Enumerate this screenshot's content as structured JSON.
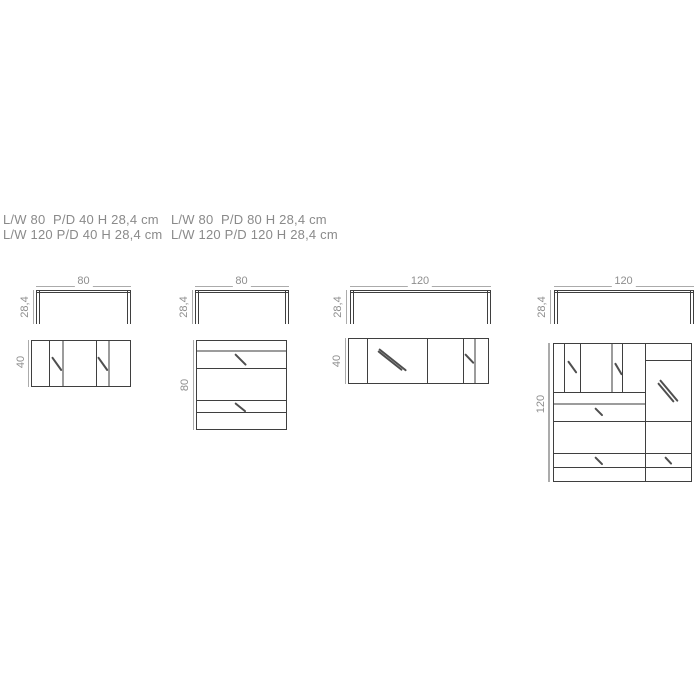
{
  "specs": {
    "col1": [
      "L/W 80  P/D 40 H 28,4 cm",
      "L/W 120 P/D 40 H 28,4 cm"
    ],
    "col2": [
      "L/W 80  P/D 80 H 28,4 cm",
      "L/W 120 P/D 120 H 28,4 cm"
    ]
  },
  "drawings": [
    {
      "width": "80",
      "height": "28,4",
      "depth": "40"
    },
    {
      "width": "80",
      "height": "28,4",
      "depth": "80"
    },
    {
      "width": "120",
      "height": "28,4",
      "depth": "40"
    },
    {
      "width": "120",
      "height": "28,4",
      "depth": "120"
    }
  ],
  "colors": {
    "line_dark": "#3f3f3f",
    "line_gray": "#9c9c9c",
    "dim_gray": "#ababab",
    "text_gray": "#8a8a8a"
  }
}
